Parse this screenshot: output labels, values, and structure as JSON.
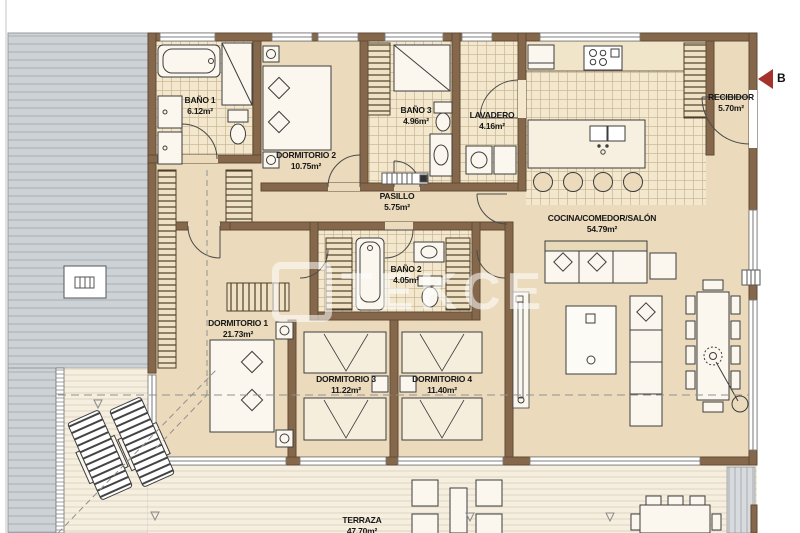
{
  "plan": {
    "watermark": "TEKCE",
    "entrance_label": "B",
    "rooms": {
      "bano1": {
        "name": "BAÑO 1",
        "area": "6.12m²"
      },
      "dormitorio2": {
        "name": "DORMITORIO 2",
        "area": "10.75m²"
      },
      "bano3": {
        "name": "BAÑO 3",
        "area": "4.96m²"
      },
      "lavadero": {
        "name": "LAVADERO",
        "area": "4.16m²"
      },
      "recibidor": {
        "name": "RECIBIDOR",
        "area": "5.70m²"
      },
      "pasillo": {
        "name": "PASILLO",
        "area": "5.75m²"
      },
      "cocina": {
        "name": "COCINA/COMEDOR/SALÓN",
        "area": "54.79m²"
      },
      "bano2": {
        "name": "BAÑO 2",
        "area": "4.05m²"
      },
      "dormitorio1": {
        "name": "DORMITORIO 1",
        "area": "21.73m²"
      },
      "dormitorio3": {
        "name": "DORMITORIO 3",
        "area": "11.22m²"
      },
      "dormitorio4": {
        "name": "DORMITORIO 4",
        "area": "11.40m²"
      },
      "terraza": {
        "name": "TERRAZA",
        "area": "47.70m²"
      }
    },
    "colors": {
      "wall": "#85684c",
      "floor": "#ebdbbc",
      "tile": "#f3e8cd",
      "deck": "#f6efe0",
      "roof": "#cdd2d6",
      "arrow": "#a5322c"
    }
  }
}
